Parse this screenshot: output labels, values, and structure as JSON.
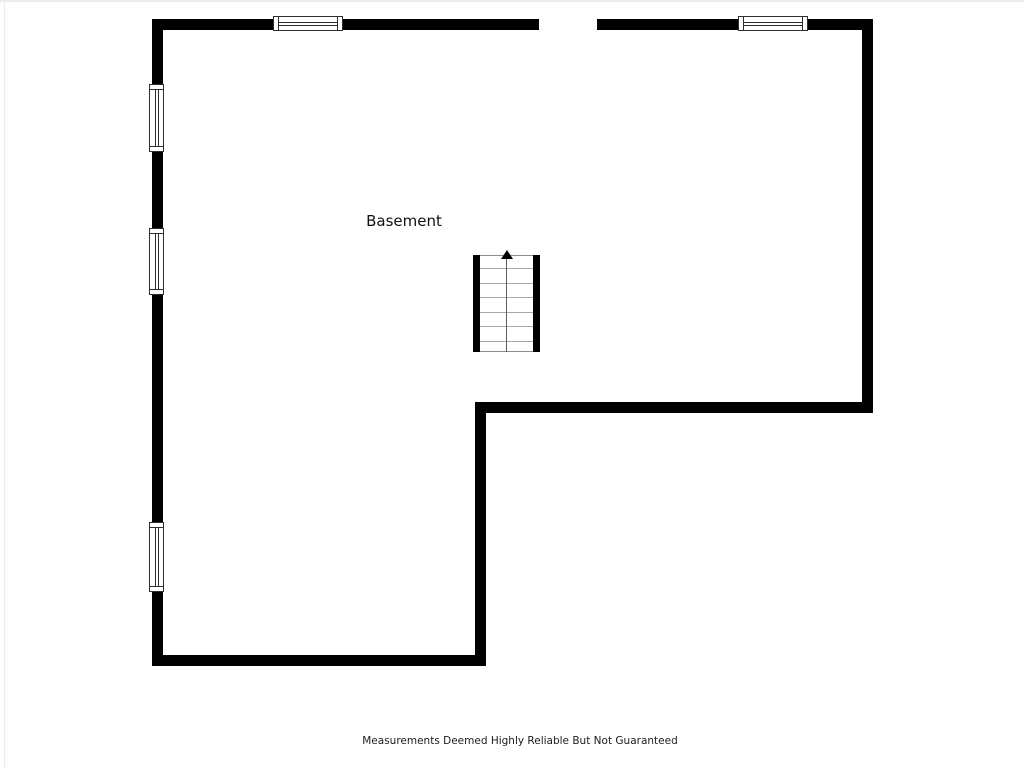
{
  "floorplan": {
    "room_label": "Basement",
    "disclaimer": "Measurements Deemed Highly Reliable But Not Guaranteed",
    "stairs": {
      "direction": "up",
      "tread_rows": 7
    },
    "windows": {
      "top_wall_count": 2,
      "left_wall_count": 3
    },
    "door_opening": {
      "location": "top-wall"
    },
    "colors": {
      "wall": "#000000",
      "window_frame": "#2e2e2e",
      "tread": "#a8a8a8",
      "stair_edge": "#8c8c8c",
      "centerline": "#5a5a5a",
      "arrow": "#000000",
      "label_text": "#111111",
      "disclaimer_text": "#1c1c1c",
      "frame_line": "#ececec"
    }
  }
}
